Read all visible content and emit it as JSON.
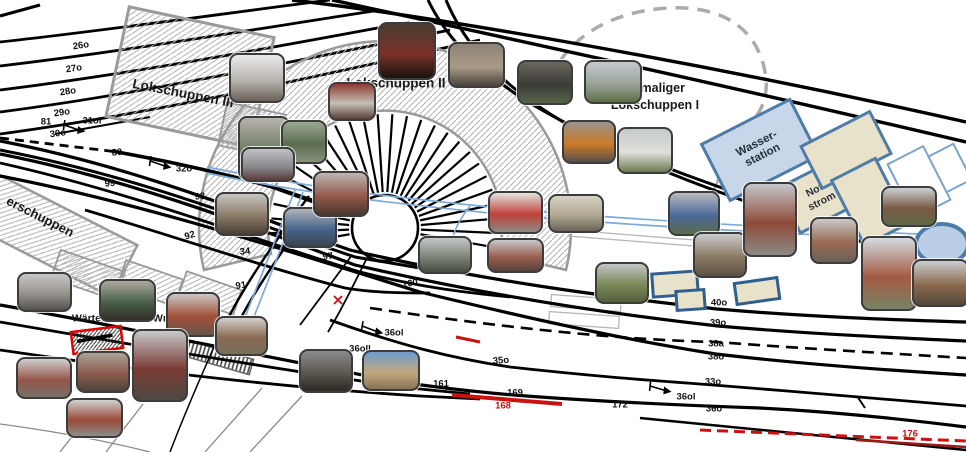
{
  "map": {
    "description": "Gleisplan Bahnbetriebswerk mit Fotoeinblendungen",
    "colors": {
      "track": "#000000",
      "hatch_line": "#b3b3b3",
      "building_outline": "#9a9a9a",
      "pipe_blue": "#7cabdb",
      "former_building_dash": "#ababab",
      "red_accent": "#cc1111",
      "box_border_blue": "#4e7ca8",
      "box_fill_blue": "#c7d7e9",
      "box_fill_tan": "#e9e2ca",
      "ellipse_fill": "#bacee6"
    },
    "buildings": {
      "lokschuppen3": "Lokschuppen III",
      "lokschuppen2": "Lokschuppen II",
      "ehemaliger_line1": "ehemaliger",
      "ehemaliger_line2": "Lokschuppen I",
      "gueterschuppen_partial": "erschuppen",
      "waerterstellwerk": "Wärterstellwerk Wm",
      "h_partial": "H"
    },
    "boxes": {
      "wasserstation": {
        "line1": "Wasser-",
        "line2": "station"
      },
      "notstrom": {
        "line1": "Not-",
        "line2": "strom"
      }
    },
    "track_labels": [
      {
        "text": "26o",
        "x": 81,
        "y": 46,
        "rot": -8
      },
      {
        "text": "27o",
        "x": 74,
        "y": 69,
        "rot": -8
      },
      {
        "text": "28o",
        "x": 68,
        "y": 92,
        "rot": -8
      },
      {
        "text": "29o",
        "x": 62,
        "y": 113,
        "rot": -8
      },
      {
        "text": "30o",
        "x": 58,
        "y": 134,
        "rot": -8
      },
      {
        "text": "81",
        "x": 46,
        "y": 122,
        "rot": 0
      },
      {
        "text": "31ol",
        "x": 92,
        "y": 121,
        "rot": 0
      },
      {
        "text": "80",
        "x": 117,
        "y": 153,
        "rot": -6
      },
      {
        "text": "32o",
        "x": 184,
        "y": 169,
        "rot": 0
      },
      {
        "text": "99",
        "x": 110,
        "y": 184,
        "rot": -6
      },
      {
        "text": "98",
        "x": 200,
        "y": 197,
        "rot": -6
      },
      {
        "text": "92",
        "x": 190,
        "y": 236,
        "rot": -16
      },
      {
        "text": "34",
        "x": 245,
        "y": 252,
        "rot": -6
      },
      {
        "text": "91",
        "x": 241,
        "y": 286,
        "rot": -10
      },
      {
        "text": "86",
        "x": 333,
        "y": 241,
        "rot": -8
      },
      {
        "text": "97",
        "x": 328,
        "y": 257,
        "rot": -8
      },
      {
        "text": "100",
        "x": 410,
        "y": 284,
        "rot": -8
      },
      {
        "text": "36ol",
        "x": 394,
        "y": 333,
        "rot": 0
      },
      {
        "text": "36oll",
        "x": 360,
        "y": 349,
        "rot": 0
      },
      {
        "text": "35o",
        "x": 501,
        "y": 361,
        "rot": -4
      },
      {
        "text": "161",
        "x": 441,
        "y": 384,
        "rot": 0
      },
      {
        "text": "169",
        "x": 515,
        "y": 393,
        "rot": 0
      },
      {
        "text": "168",
        "x": 503,
        "y": 406,
        "rot": 0,
        "color": "#cc1111"
      },
      {
        "text": "172",
        "x": 620,
        "y": 405,
        "rot": 0
      },
      {
        "text": "36ol",
        "x": 686,
        "y": 397,
        "rot": 0
      },
      {
        "text": "40o",
        "x": 719,
        "y": 303,
        "rot": 0
      },
      {
        "text": "39o",
        "x": 718,
        "y": 323,
        "rot": 0
      },
      {
        "text": "38a",
        "x": 716,
        "y": 344,
        "rot": 0
      },
      {
        "text": "38o",
        "x": 716,
        "y": 357,
        "rot": 0
      },
      {
        "text": "33o",
        "x": 713,
        "y": 382,
        "rot": 0
      },
      {
        "text": "36o",
        "x": 714,
        "y": 409,
        "rot": 0
      },
      {
        "text": "176",
        "x": 910,
        "y": 434,
        "rot": 0,
        "color": "#cc1111"
      }
    ],
    "aux_boxes": [
      {
        "name": "tan-box-northeast",
        "x": 843,
        "y": 147,
        "w": 74,
        "h": 44,
        "rot": -27,
        "fill": "#e9e2ca",
        "border": "#4e7ca8",
        "bw": 3.5
      },
      {
        "name": "tan-box-east",
        "x": 867,
        "y": 199,
        "w": 46,
        "h": 70,
        "rot": -27,
        "fill": "#e9e2ca",
        "border": "#4e7ca8",
        "bw": 3.5
      },
      {
        "name": "white-box-northeast",
        "x": 917,
        "y": 180,
        "w": 38,
        "h": 58,
        "rot": -27,
        "fill": "#ffffff",
        "border": "#7aa3cc",
        "bw": 2
      },
      {
        "name": "white-box-edge",
        "x": 948,
        "y": 166,
        "w": 26,
        "h": 38,
        "rot": -27,
        "fill": "#ffffff",
        "border": "#7aa3cc",
        "bw": 2
      },
      {
        "name": "tan-box-l1",
        "x": 672,
        "y": 281,
        "w": 42,
        "h": 20,
        "rot": -4,
        "fill": "#e9e2ca",
        "border": "#2f5f8f",
        "bw": 3
      },
      {
        "name": "tan-box-l2",
        "x": 687,
        "y": 297,
        "w": 25,
        "h": 16,
        "rot": -4,
        "fill": "#e9e2ca",
        "border": "#2f5f8f",
        "bw": 3
      },
      {
        "name": "tan-box-right",
        "x": 754,
        "y": 288,
        "w": 40,
        "h": 18,
        "rot": -8,
        "fill": "#e9e2ca",
        "border": "#2f5f8f",
        "bw": 3
      }
    ],
    "photos": [
      {
        "name": "shed-interior-red-loco",
        "x": 378,
        "y": 22,
        "w": 54,
        "h": 54,
        "c": [
          "#4a3c30",
          "#7a3228",
          "#181310"
        ]
      },
      {
        "name": "museum-corridor",
        "x": 229,
        "y": 53,
        "w": 52,
        "h": 46,
        "c": [
          "#e9e9ec",
          "#b9b5af",
          "#69615a"
        ]
      },
      {
        "name": "workshop-table",
        "x": 448,
        "y": 42,
        "w": 53,
        "h": 42,
        "c": [
          "#8e8377",
          "#a89a87",
          "#4a443c"
        ]
      },
      {
        "name": "dark-shed-corridor",
        "x": 517,
        "y": 60,
        "w": 52,
        "h": 41,
        "c": [
          "#6b675e",
          "#3b3b35",
          "#56654a"
        ]
      },
      {
        "name": "steel-frame-field",
        "x": 584,
        "y": 60,
        "w": 54,
        "h": 40,
        "c": [
          "#c4c8cb",
          "#9aa39a",
          "#5d6f47"
        ]
      },
      {
        "name": "red-wall-interior",
        "x": 328,
        "y": 82,
        "w": 44,
        "h": 35,
        "c": [
          "#8a3c30",
          "#c7bfb7",
          "#594038"
        ]
      },
      {
        "name": "machine-shop",
        "x": 238,
        "y": 116,
        "w": 48,
        "h": 60,
        "c": [
          "#b7b3ab",
          "#6a7a62",
          "#3b4337"
        ]
      },
      {
        "name": "green-machine",
        "x": 281,
        "y": 120,
        "w": 42,
        "h": 40,
        "c": [
          "#9aa892",
          "#5c6c50",
          "#86917a"
        ]
      },
      {
        "name": "street-red-car",
        "x": 241,
        "y": 147,
        "w": 50,
        "h": 31,
        "c": [
          "#bfc1c5",
          "#8a8c90",
          "#5a3c3c"
        ]
      },
      {
        "name": "house-with-trees",
        "x": 215,
        "y": 192,
        "w": 50,
        "h": 40,
        "c": [
          "#c8c6c2",
          "#8a7a66",
          "#493f35"
        ]
      },
      {
        "name": "blue-loco-canopy",
        "x": 283,
        "y": 207,
        "w": 50,
        "h": 37,
        "c": [
          "#b0b4b8",
          "#46648c",
          "#3b434f"
        ]
      },
      {
        "name": "brick-building-door",
        "x": 313,
        "y": 171,
        "w": 52,
        "h": 42,
        "c": [
          "#bcb8b4",
          "#95584a",
          "#493730"
        ]
      },
      {
        "name": "yard-tracks",
        "x": 418,
        "y": 236,
        "w": 50,
        "h": 34,
        "c": [
          "#c5c7c9",
          "#7d8578",
          "#464e44"
        ]
      },
      {
        "name": "room-red-chairs",
        "x": 488,
        "y": 191,
        "w": 51,
        "h": 39,
        "c": [
          "#e5e3e0",
          "#bf4038",
          "#8e8a84"
        ]
      },
      {
        "name": "office-room",
        "x": 548,
        "y": 194,
        "w": 52,
        "h": 35,
        "c": [
          "#d8d2c6",
          "#b0a890",
          "#696357"
        ]
      },
      {
        "name": "brick-row-building",
        "x": 487,
        "y": 238,
        "w": 53,
        "h": 31,
        "c": [
          "#c9c9cb",
          "#9a5e4e",
          "#55443b"
        ]
      },
      {
        "name": "grass-path-buildings",
        "x": 595,
        "y": 262,
        "w": 50,
        "h": 38,
        "c": [
          "#c2c4c6",
          "#7a8a58",
          "#545f3e"
        ]
      },
      {
        "name": "blue-machinery",
        "x": 668,
        "y": 191,
        "w": 48,
        "h": 41,
        "c": [
          "#b8bcc0",
          "#4a6a9a",
          "#596b49"
        ]
      },
      {
        "name": "straight-track-view",
        "x": 693,
        "y": 232,
        "w": 50,
        "h": 42,
        "c": [
          "#c9cbcd",
          "#8a7a62",
          "#5d5143"
        ]
      },
      {
        "name": "large-brick-building",
        "x": 743,
        "y": 182,
        "w": 50,
        "h": 71,
        "c": [
          "#c3c7cb",
          "#8f4a38",
          "#8a8a86"
        ]
      },
      {
        "name": "street-buildings",
        "x": 810,
        "y": 217,
        "w": 44,
        "h": 43,
        "c": [
          "#c9c9c9",
          "#9a6a54",
          "#696159"
        ]
      },
      {
        "name": "low-building-grass",
        "x": 881,
        "y": 186,
        "w": 52,
        "h": 37,
        "c": [
          "#cbd0d4",
          "#7a5a46",
          "#5e6a49"
        ]
      },
      {
        "name": "water-tower",
        "x": 861,
        "y": 236,
        "w": 52,
        "h": 71,
        "c": [
          "#d3dbe2",
          "#a45a42",
          "#798367"
        ]
      },
      {
        "name": "gantry-tracks",
        "x": 912,
        "y": 259,
        "w": 53,
        "h": 44,
        "c": [
          "#c9cdd1",
          "#8a6a4e",
          "#53483b"
        ]
      },
      {
        "name": "platform-street",
        "x": 17,
        "y": 272,
        "w": 51,
        "h": 36,
        "c": [
          "#c6c6c8",
          "#98928c",
          "#55514d"
        ]
      },
      {
        "name": "green-machines-room",
        "x": 99,
        "y": 279,
        "w": 53,
        "h": 39,
        "c": [
          "#afa99f",
          "#486049",
          "#332d27"
        ]
      },
      {
        "name": "red-station-house",
        "x": 166,
        "y": 292,
        "w": 50,
        "h": 41,
        "c": [
          "#ccc8c4",
          "#a05038",
          "#69554b"
        ]
      },
      {
        "name": "brown-building",
        "x": 215,
        "y": 316,
        "w": 49,
        "h": 36,
        "c": [
          "#d2d0cc",
          "#8a6a52",
          "#766f5d"
        ]
      },
      {
        "name": "signal-box",
        "x": 16,
        "y": 357,
        "w": 52,
        "h": 38,
        "c": [
          "#cfcfcf",
          "#96564a",
          "#776f67"
        ]
      },
      {
        "name": "lever-frame",
        "x": 76,
        "y": 351,
        "w": 50,
        "h": 38,
        "c": [
          "#aba399",
          "#8c5a4c",
          "#4d453d"
        ]
      },
      {
        "name": "signal-box-closeup",
        "x": 132,
        "y": 329,
        "w": 52,
        "h": 69,
        "c": [
          "#c7c9cb",
          "#7a3c34",
          "#4d4943"
        ]
      },
      {
        "name": "red-roof-building",
        "x": 66,
        "y": 398,
        "w": 53,
        "h": 36,
        "c": [
          "#d1d1d1",
          "#9a4a3a",
          "#8c8c88"
        ]
      },
      {
        "name": "dark-platform-train",
        "x": 299,
        "y": 349,
        "w": 50,
        "h": 40,
        "c": [
          "#8c8c8e",
          "#5c584e",
          "#2d2923"
        ]
      },
      {
        "name": "sky-platform-panorama",
        "x": 362,
        "y": 350,
        "w": 54,
        "h": 37,
        "c": [
          "#6d9ccd",
          "#c2a87e",
          "#897353"
        ]
      },
      {
        "name": "orange-digger-shed",
        "x": 562,
        "y": 120,
        "w": 50,
        "h": 40,
        "c": [
          "#99938b",
          "#cb7a28",
          "#564f49"
        ]
      },
      {
        "name": "white-column-grass",
        "x": 617,
        "y": 127,
        "w": 52,
        "h": 43,
        "c": [
          "#c6cacc",
          "#dfdfdb",
          "#6d7951"
        ]
      }
    ],
    "switches": [
      {
        "x": 64,
        "y": 126,
        "rot": 8
      },
      {
        "x": 150,
        "y": 162,
        "rot": 8
      },
      {
        "x": 362,
        "y": 327,
        "rot": 10
      },
      {
        "x": 650,
        "y": 387,
        "rot": 6
      }
    ]
  }
}
